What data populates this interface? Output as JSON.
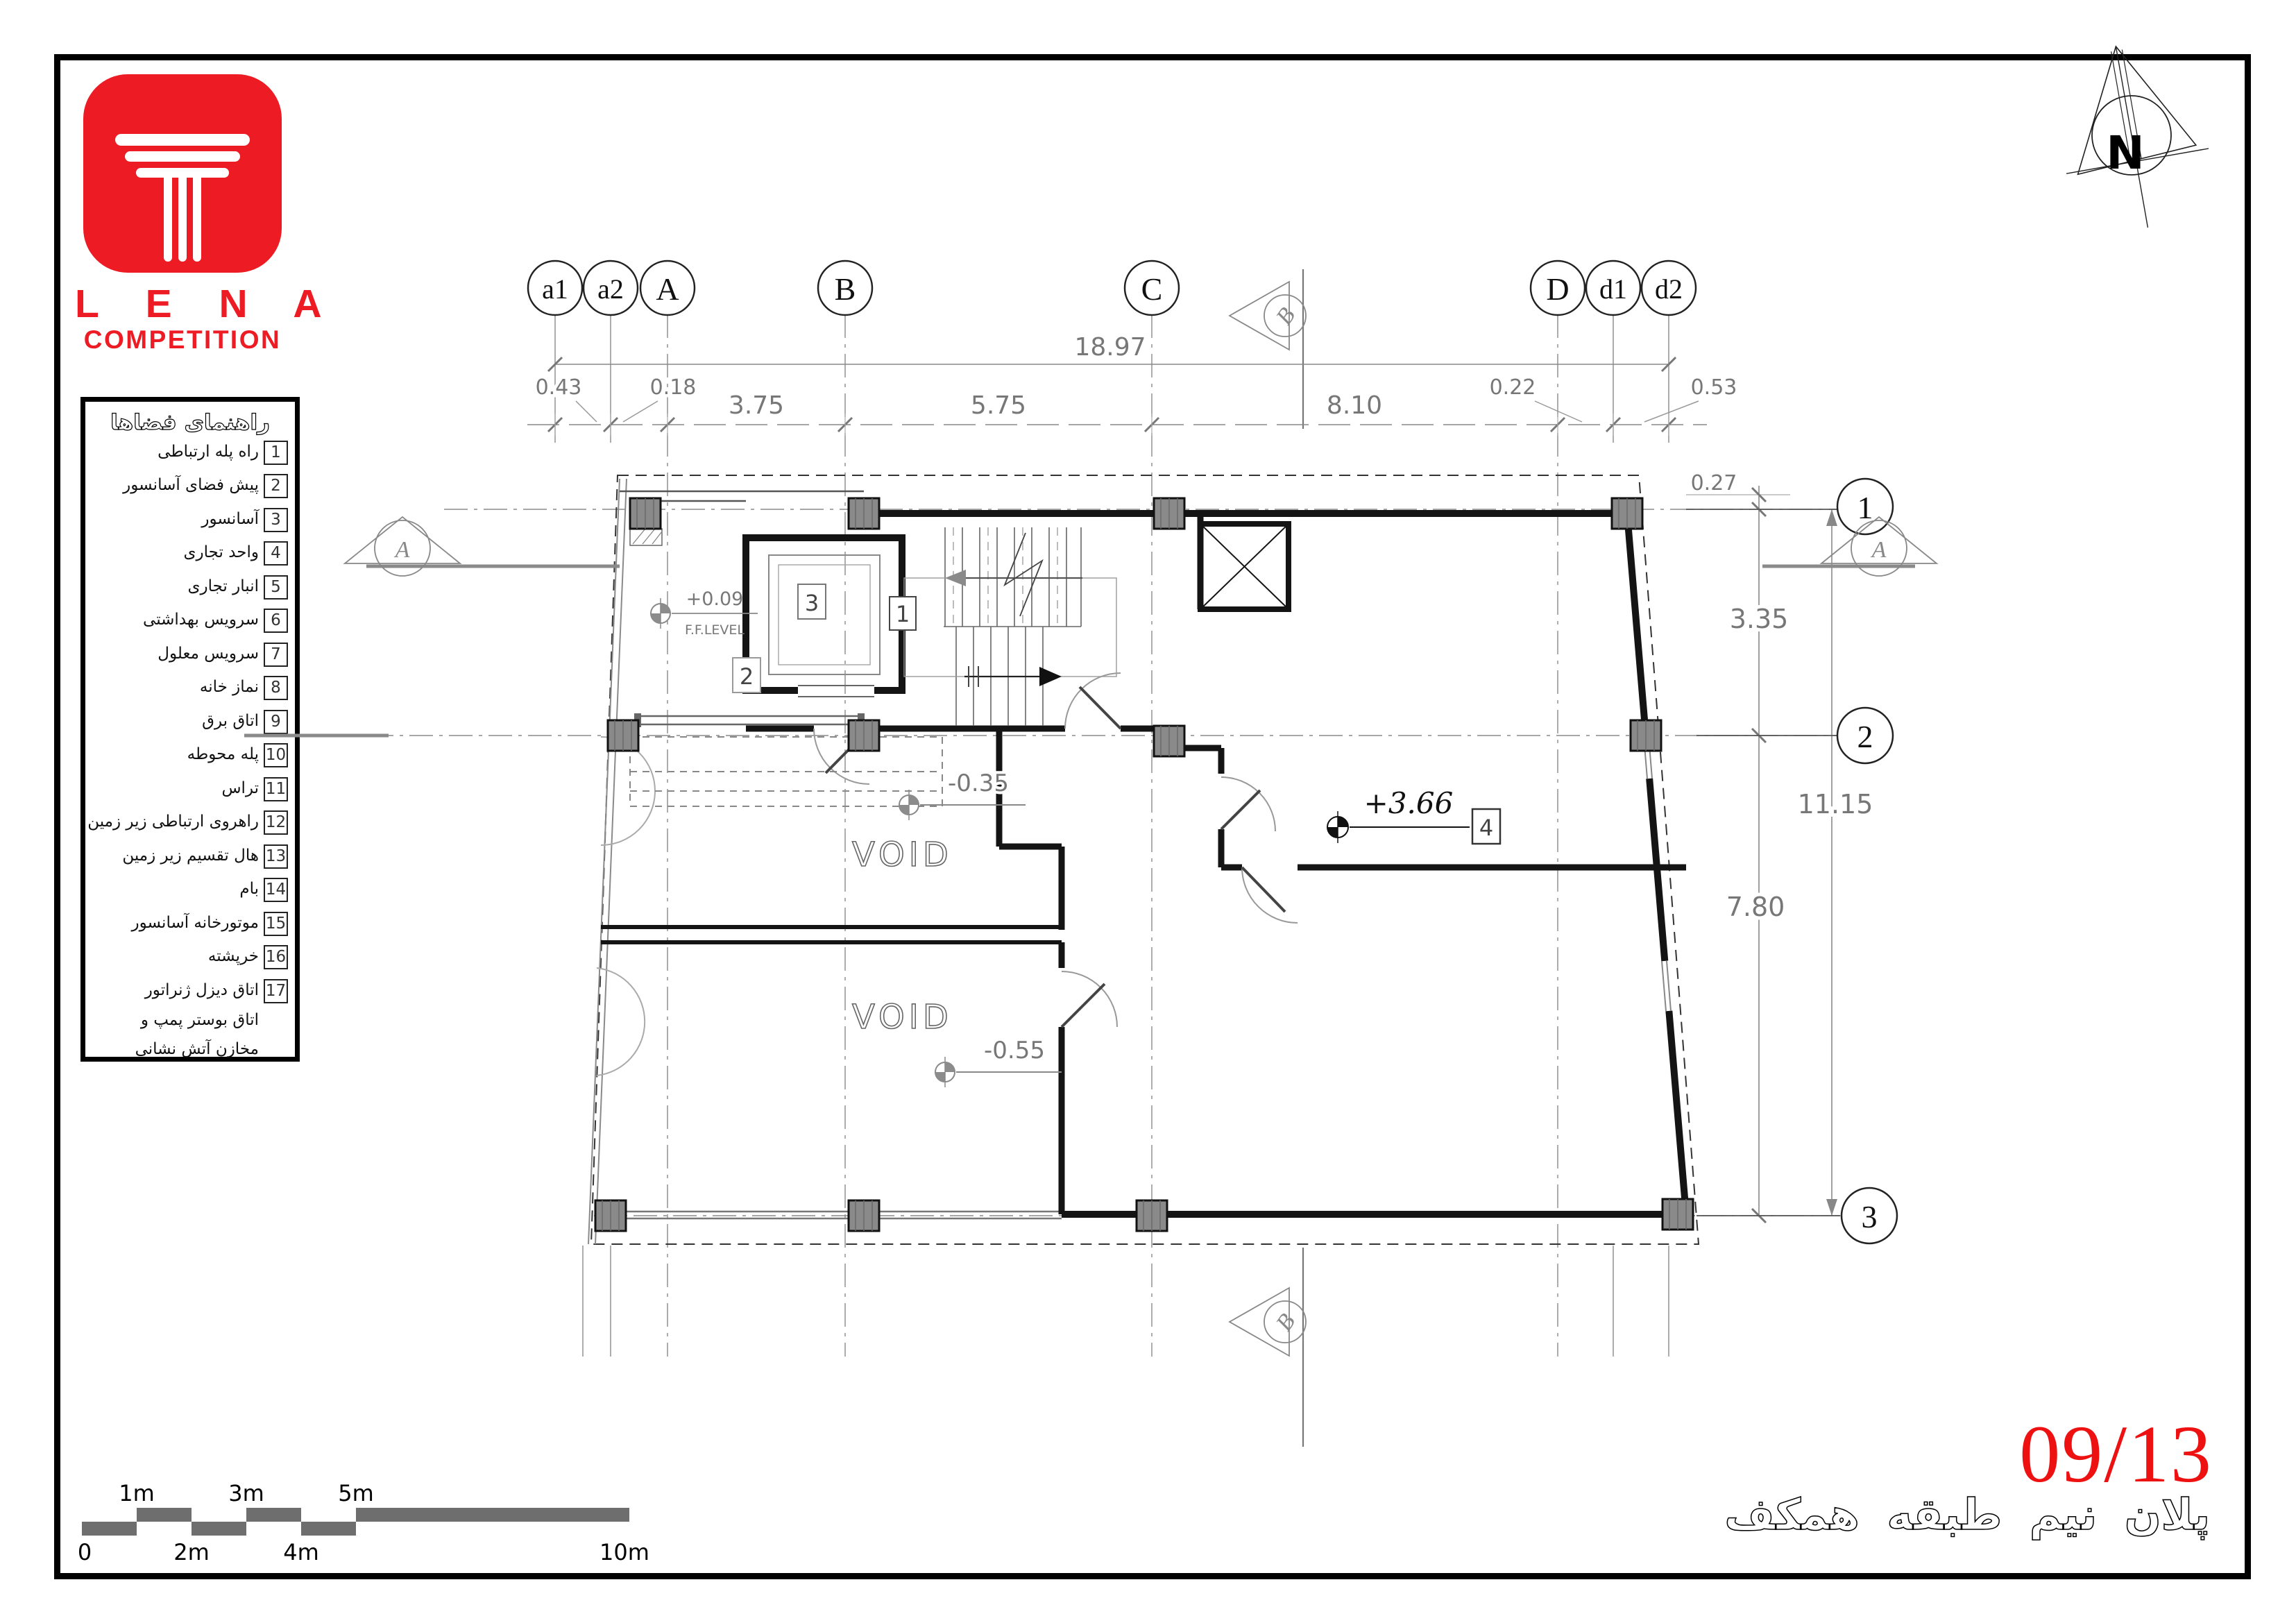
{
  "logo": {
    "brand": "L E N A",
    "sub": "COMPETITION"
  },
  "legend": {
    "title": "راهنمای فضاها",
    "items": [
      {
        "num": "1",
        "label": "راه پله ارتباطی"
      },
      {
        "num": "2",
        "label": "پیش فضای آسانسور"
      },
      {
        "num": "3",
        "label": "آسانسور"
      },
      {
        "num": "4",
        "label": "واحد تجاری"
      },
      {
        "num": "5",
        "label": "انبار تجاری"
      },
      {
        "num": "6",
        "label": "سرویس بهداشتی"
      },
      {
        "num": "7",
        "label": "سرویس معلول"
      },
      {
        "num": "8",
        "label": "نماز خانه"
      },
      {
        "num": "9",
        "label": "اتاق برق"
      },
      {
        "num": "10",
        "label": "پله محوطه"
      },
      {
        "num": "11",
        "label": "تراس"
      },
      {
        "num": "12",
        "label": "راهروی ارتباطی زیر زمین"
      },
      {
        "num": "13",
        "label": "هال تقسیم زیر زمین"
      },
      {
        "num": "14",
        "label": "بام"
      },
      {
        "num": "15",
        "label": "موتورخانه آسانسور"
      },
      {
        "num": "16",
        "label": "خرپشته"
      },
      {
        "num": "17",
        "label": "اتاق دیزل ژنراتور",
        "label2": "اتاق بوستر پمپ و",
        "label3": "مخازن آتش نشانی"
      }
    ]
  },
  "grid_bubbles": {
    "top": [
      "a1",
      "a2",
      "A",
      "B",
      "C",
      "D",
      "d1",
      "d2"
    ],
    "side": [
      "1",
      "2",
      "3"
    ]
  },
  "dimensions": {
    "total": "18.97",
    "seg_ab": "3.75",
    "seg_bc": "5.75",
    "seg_cd": "8.10",
    "a1_a2": "0.43",
    "a2_A": "0.18",
    "D_d1": "0.22",
    "d1_d2": "0.53",
    "offset_top": "0.27",
    "row_1_2": "3.35",
    "row_2_3": "7.80",
    "total_v": "11.15"
  },
  "levels": {
    "ff": "+0.09",
    "ff_label": "F.F.LEVEL",
    "void_upper": "-0.35",
    "void_lower": "-0.55",
    "room4": "+3.66"
  },
  "rooms": {
    "void": "VOID",
    "tags": [
      "1",
      "2",
      "3",
      "4"
    ]
  },
  "sections": {
    "a": "A",
    "b": "B"
  },
  "north_label": "N",
  "scale_bar": {
    "above": [
      "1m",
      "3m",
      "5m"
    ],
    "below": [
      "0",
      "2m",
      "4m",
      "10m"
    ]
  },
  "title_block": {
    "sheet_no": "09/13",
    "caption": "پلان نیم طبقه همکف"
  },
  "colors": {
    "accent_red": "#ED1C24",
    "sheet_red": "#EE1111",
    "dim_gray": "#777777",
    "column_gray": "#8a8a8a",
    "scale_gray": "#6e6e6e"
  }
}
